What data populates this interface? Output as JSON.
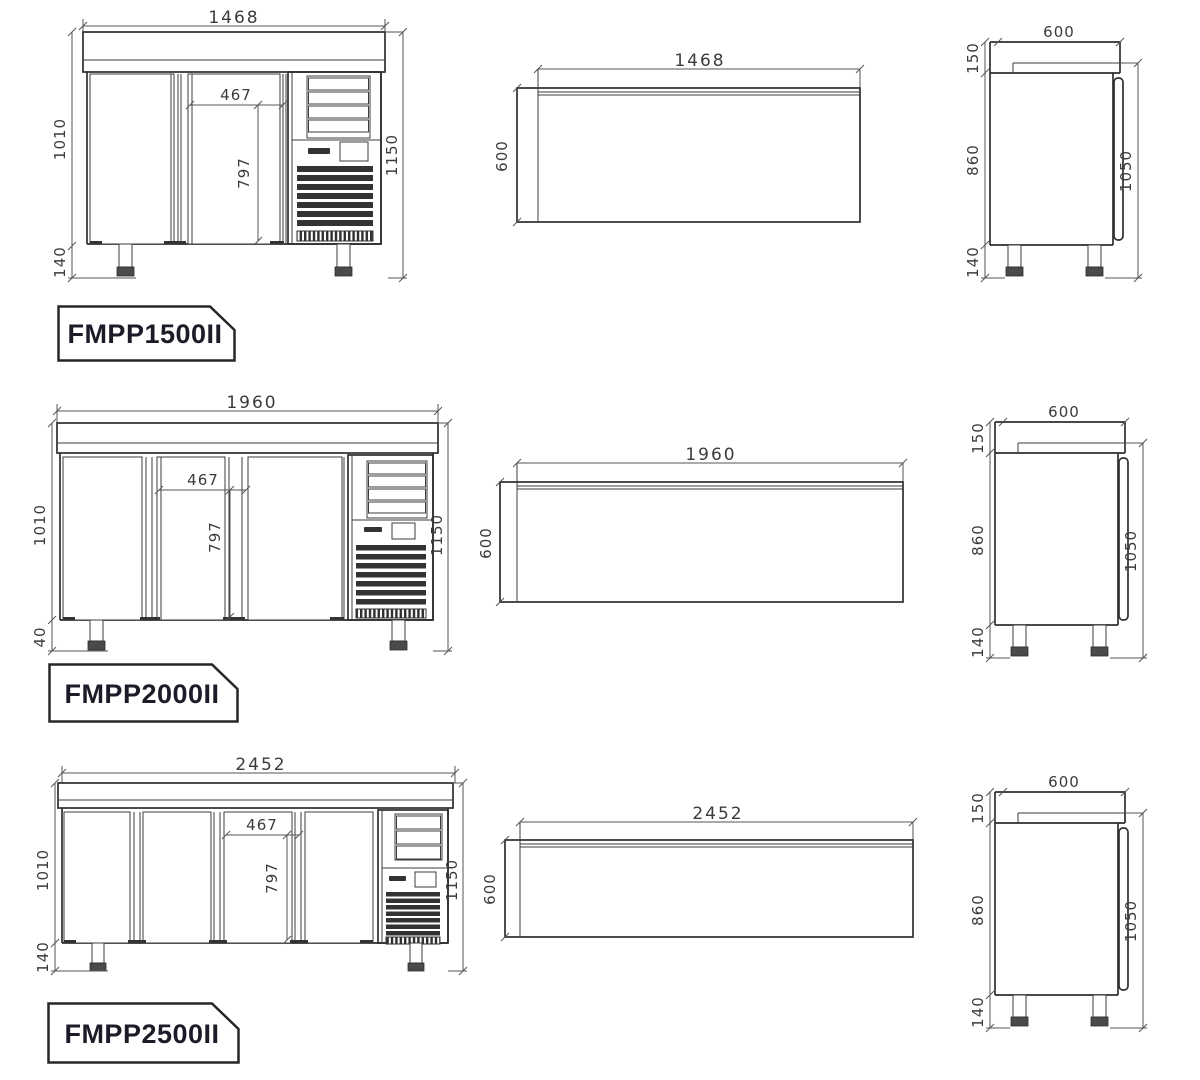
{
  "sheet_title": "Refrigerated counter dimension drawings",
  "colors": {
    "line": "#2e2e2e",
    "dimension": "#555555",
    "label_text": "#1c1c28",
    "background": "#ffffff"
  },
  "models": [
    {
      "label": "FMPP1500II",
      "front": {
        "overall_width": "1468",
        "interior_height": "1010",
        "foot_height": "140",
        "door_opening_width": "467",
        "door_opening_height": "797",
        "overall_height": "1150"
      },
      "top": {
        "overall_width": "1468",
        "depth": "600"
      },
      "side": {
        "depth": "600",
        "worktop_height": "150",
        "body_height": "860",
        "foot_height": "140",
        "side_height": "1050"
      }
    },
    {
      "label": "FMPP2000II",
      "front": {
        "overall_width": "1960",
        "interior_height": "1010",
        "foot_height": "40",
        "door_opening_width": "467",
        "door_opening_height": "797",
        "overall_height": "1150"
      },
      "top": {
        "overall_width": "1960",
        "depth": "600"
      },
      "side": {
        "depth": "600",
        "worktop_height": "150",
        "body_height": "860",
        "foot_height": "140",
        "side_height": "1050"
      }
    },
    {
      "label": "FMPP2500II",
      "front": {
        "overall_width": "2452",
        "interior_height": "1010",
        "foot_height": "140",
        "door_opening_width": "467",
        "door_opening_height": "797",
        "overall_height": "1150"
      },
      "top": {
        "overall_width": "2452",
        "depth": "600"
      },
      "side": {
        "depth": "600",
        "worktop_height": "150",
        "body_height": "860",
        "foot_height": "140",
        "side_height": "1050"
      }
    }
  ]
}
